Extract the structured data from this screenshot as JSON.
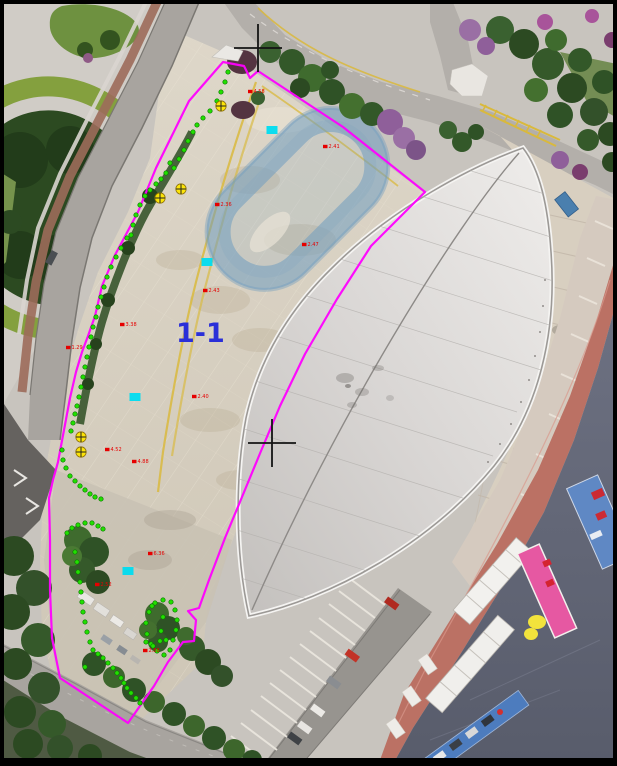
{
  "figure": {
    "kind": "aerial-survey-orthophoto",
    "frame_color": "#000000",
    "width": 617,
    "height": 766
  },
  "colors": {
    "boundary": "#ff00ff",
    "survey_dot": "#22e000",
    "survey_dot_edge": "#0a7a00",
    "control_marker": "#ffe600",
    "control_marker_edge": "#8a6d00",
    "cyan_mark": "#00dcf0",
    "spot_label": "#e60000",
    "crosshair": "#141414",
    "section_label": "#2a2fd8"
  },
  "annotations": {
    "section_label": {
      "text": "1-1",
      "x": 176,
      "y": 342,
      "font_size": 27
    },
    "boundary": {
      "points": [
        [
          223,
          62
        ],
        [
          244,
          66
        ],
        [
          250,
          78
        ],
        [
          258,
          71
        ],
        [
          343,
          127
        ],
        [
          425,
          192
        ],
        [
          371,
          246
        ],
        [
          337,
          299
        ],
        [
          305,
          354
        ],
        [
          280,
          406
        ],
        [
          261,
          451
        ],
        [
          242,
          497
        ],
        [
          225,
          538
        ],
        [
          209,
          580
        ],
        [
          199,
          608
        ],
        [
          188,
          611
        ],
        [
          196,
          620
        ],
        [
          194,
          641
        ],
        [
          183,
          642
        ],
        [
          168,
          662
        ],
        [
          154,
          686
        ],
        [
          128,
          723
        ],
        [
          60,
          678
        ],
        [
          52,
          638
        ],
        [
          50,
          590
        ],
        [
          50,
          540
        ],
        [
          49,
          498
        ],
        [
          53,
          480
        ],
        [
          58,
          462
        ],
        [
          64,
          430
        ],
        [
          70,
          398
        ],
        [
          76,
          372
        ],
        [
          82,
          352
        ],
        [
          88,
          336
        ],
        [
          95,
          316
        ],
        [
          102,
          286
        ],
        [
          115,
          255
        ],
        [
          138,
          212
        ],
        [
          156,
          168
        ],
        [
          189,
          101
        ]
      ]
    },
    "survey_dots": {
      "points": [
        [
          228,
          72
        ],
        [
          225,
          82
        ],
        [
          221,
          92
        ],
        [
          217,
          101
        ],
        [
          210,
          111
        ],
        [
          203,
          118
        ],
        [
          197,
          125
        ],
        [
          193,
          132
        ],
        [
          188,
          141
        ],
        [
          184,
          150
        ],
        [
          179,
          159
        ],
        [
          174,
          168
        ],
        [
          170,
          163
        ],
        [
          166,
          173
        ],
        [
          161,
          179
        ],
        [
          156,
          184
        ],
        [
          150,
          190
        ],
        [
          145,
          196
        ],
        [
          140,
          205
        ],
        [
          136,
          215
        ],
        [
          133,
          225
        ],
        [
          131,
          235
        ],
        [
          127,
          238
        ],
        [
          121,
          248
        ],
        [
          116,
          257
        ],
        [
          111,
          267
        ],
        [
          107,
          277
        ],
        [
          104,
          287
        ],
        [
          101,
          297
        ],
        [
          98,
          307
        ],
        [
          96,
          317
        ],
        [
          93,
          327
        ],
        [
          91,
          337
        ],
        [
          89,
          347
        ],
        [
          87,
          357
        ],
        [
          85,
          367
        ],
        [
          83,
          377
        ],
        [
          81,
          387
        ],
        [
          79,
          397
        ],
        [
          77,
          406
        ],
        [
          75,
          414
        ],
        [
          73,
          423
        ],
        [
          71,
          431
        ],
        [
          62,
          450
        ],
        [
          63,
          460
        ],
        [
          66,
          468
        ],
        [
          70,
          476
        ],
        [
          75,
          481
        ],
        [
          80,
          486
        ],
        [
          85,
          490
        ],
        [
          90,
          494
        ],
        [
          95,
          497
        ],
        [
          101,
          499
        ],
        [
          67,
          533
        ],
        [
          72,
          528
        ],
        [
          78,
          525
        ],
        [
          85,
          523
        ],
        [
          92,
          523
        ],
        [
          98,
          526
        ],
        [
          103,
          529
        ],
        [
          75,
          552
        ],
        [
          77,
          562
        ],
        [
          78,
          572
        ],
        [
          80,
          582
        ],
        [
          81,
          592
        ],
        [
          82,
          602
        ],
        [
          83,
          612
        ],
        [
          85,
          622
        ],
        [
          87,
          632
        ],
        [
          90,
          642
        ],
        [
          93,
          650
        ],
        [
          98,
          654
        ],
        [
          103,
          658
        ],
        [
          108,
          663
        ],
        [
          113,
          668
        ],
        [
          117,
          673
        ],
        [
          121,
          678
        ],
        [
          124,
          683
        ],
        [
          127,
          688
        ],
        [
          131,
          693
        ],
        [
          136,
          698
        ],
        [
          140,
          703
        ],
        [
          85,
          667
        ],
        [
          155,
          603
        ],
        [
          163,
          600
        ],
        [
          171,
          602
        ],
        [
          175,
          610
        ],
        [
          177,
          620
        ],
        [
          176,
          630
        ],
        [
          173,
          640
        ],
        [
          170,
          650
        ],
        [
          164,
          655
        ],
        [
          157,
          651
        ],
        [
          151,
          644
        ],
        [
          147,
          634
        ],
        [
          146,
          623
        ],
        [
          149,
          612
        ],
        [
          152,
          606
        ],
        [
          163,
          617
        ],
        [
          161,
          631
        ],
        [
          166,
          640
        ],
        [
          146,
          642
        ],
        [
          153,
          646
        ],
        [
          160,
          641
        ]
      ]
    },
    "control_markers": {
      "points": [
        [
          221,
          106
        ],
        [
          181,
          189
        ],
        [
          160,
          198
        ],
        [
          81,
          437
        ],
        [
          81,
          452
        ]
      ]
    },
    "cyan_marks": {
      "points": [
        [
          272,
          130
        ],
        [
          207,
          262
        ],
        [
          135,
          397
        ],
        [
          128,
          571
        ]
      ]
    },
    "spot_labels": {
      "items": [
        {
          "x": 248,
          "y": 92,
          "text": "4.58"
        },
        {
          "x": 215,
          "y": 205,
          "text": "2.36"
        },
        {
          "x": 203,
          "y": 291,
          "text": "2.43"
        },
        {
          "x": 192,
          "y": 397,
          "text": "2.40"
        },
        {
          "x": 323,
          "y": 147,
          "text": "2.41"
        },
        {
          "x": 302,
          "y": 245,
          "text": "2.47"
        },
        {
          "x": 105,
          "y": 450,
          "text": "4.52"
        },
        {
          "x": 132,
          "y": 462,
          "text": "4.88"
        },
        {
          "x": 120,
          "y": 325,
          "text": "3.38"
        },
        {
          "x": 66,
          "y": 348,
          "text": "1.29"
        },
        {
          "x": 148,
          "y": 554,
          "text": "6.36"
        },
        {
          "x": 95,
          "y": 585,
          "text": "2.52"
        },
        {
          "x": 143,
          "y": 651,
          "text": "2.88"
        }
      ]
    },
    "crosshairs": {
      "points": [
        {
          "x": 258,
          "y": 48,
          "arm": 24
        },
        {
          "x": 272,
          "y": 443,
          "arm": 24
        }
      ]
    }
  }
}
